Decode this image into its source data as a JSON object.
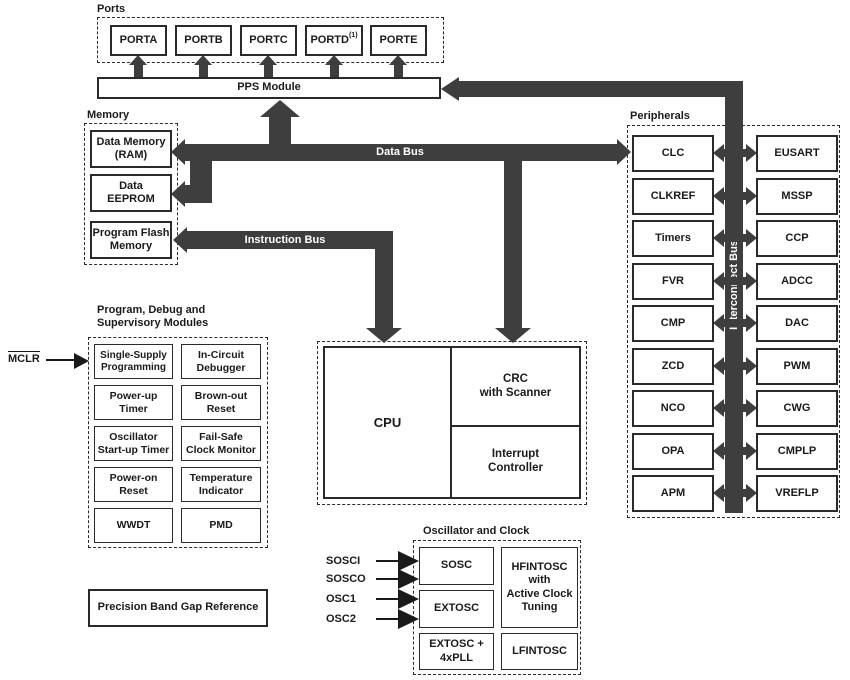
{
  "colors": {
    "bus": "#3e3e3e",
    "border": "#2a2a2a",
    "background": "#ffffff"
  },
  "ports": {
    "title": "Ports",
    "items": [
      "PORTA",
      "PORTB",
      "PORTC",
      "PORTD",
      "PORTE"
    ],
    "portd_superscript": "(1)"
  },
  "pps": {
    "label": "PPS Module"
  },
  "memory": {
    "title": "Memory",
    "ram": "Data Memory\n(RAM)",
    "eeprom": "Data\nEEPROM",
    "flash": "Program Flash\nMemory"
  },
  "buses": {
    "data": "Data Bus",
    "instruction": "Instruction Bus",
    "interconnect": "Interconnect Bus"
  },
  "peripherals": {
    "title": "Peripherals",
    "left": [
      "CLC",
      "CLKREF",
      "Timers",
      "FVR",
      "CMP",
      "ZCD",
      "NCO",
      "OPA",
      "APM"
    ],
    "right": [
      "EUSART",
      "MSSP",
      "CCP",
      "ADCC",
      "DAC",
      "PWM",
      "CWG",
      "CMPLP",
      "VREFLP"
    ]
  },
  "debug": {
    "title": "Program, Debug and\nSupervisory Modules",
    "mclr": "MCLR",
    "cells": [
      "Single-Supply\nProgramming",
      "In-Circuit\nDebugger",
      "Power-up\nTimer",
      "Brown-out\nReset",
      "Oscillator\nStart-up Timer",
      "Fail-Safe\nClock Monitor",
      "Power-on\nReset",
      "Temperature\nIndicator",
      "WWDT",
      "PMD"
    ]
  },
  "cpu": {
    "main": "CPU",
    "crc": "CRC\nwith Scanner",
    "interrupt": "Interrupt\nController"
  },
  "oscillator": {
    "title": "Oscillator and Clock",
    "inputs": [
      "SOSCI",
      "SOSCO",
      "OSC1",
      "OSC2"
    ],
    "sosc": "SOSC",
    "extosc": "EXTOSC",
    "extosc_pll": "EXTOSC +\n4xPLL",
    "hfintosc": "HFINTOSC\nwith\nActive Clock\nTuning",
    "lfintosc": "LFINTOSC"
  },
  "bandgap": {
    "label": "Precision Band Gap Reference"
  }
}
